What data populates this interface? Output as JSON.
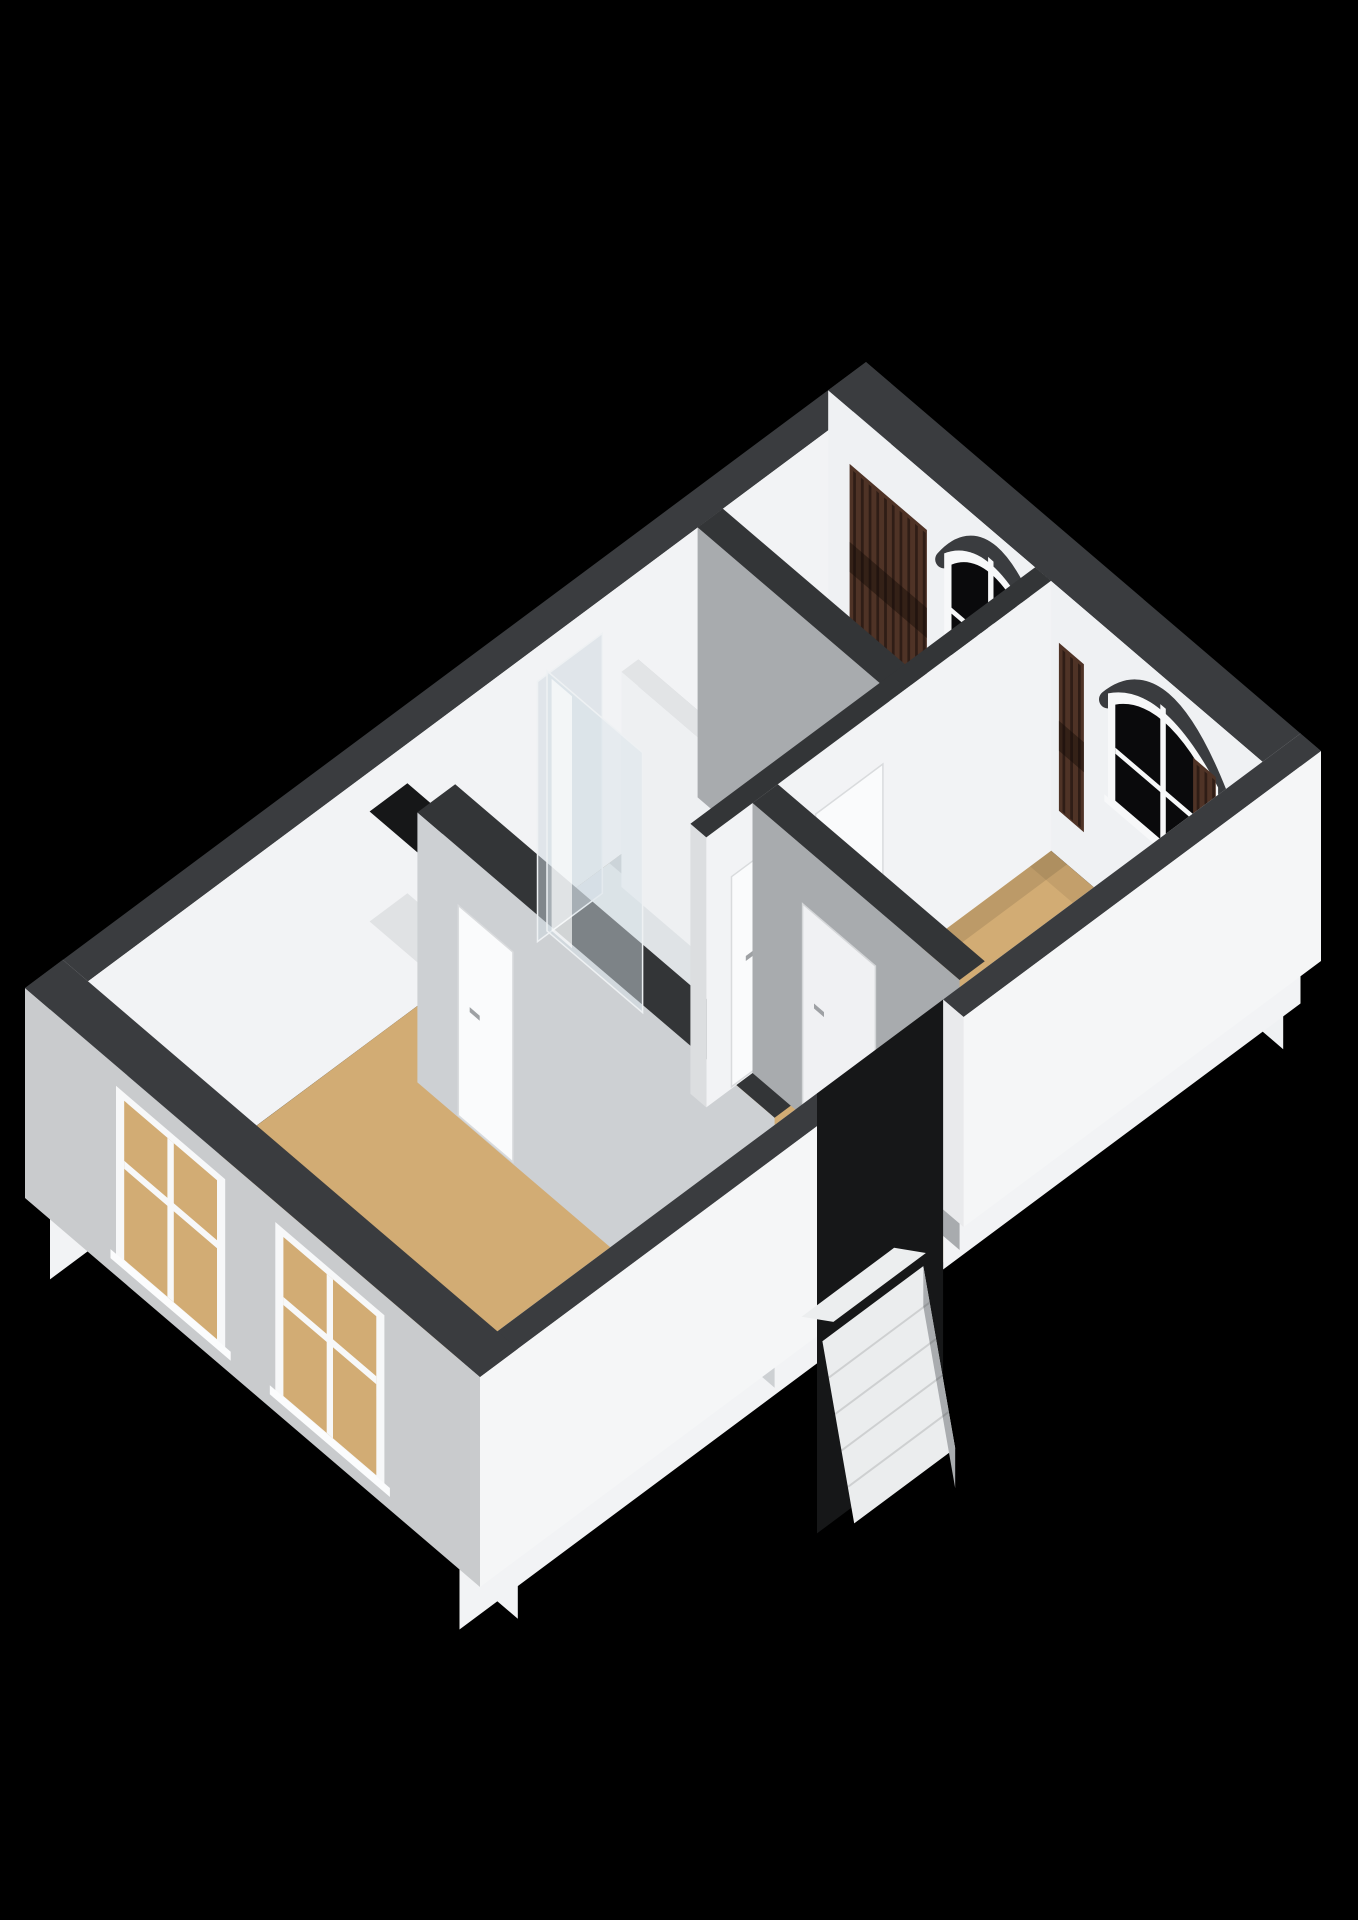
{
  "meta": {
    "description": "3D dollhouse-style floor plan render on black background, no visible text",
    "background": "#000000"
  },
  "canvas": {
    "width": 1358,
    "height": 1920
  },
  "projection": {
    "origin": [
      25,
      988
    ],
    "a_axis": [
      841,
      -626
    ],
    "b_axis": [
      455,
      389
    ],
    "wall_height": 270,
    "facade_drop": 210
  },
  "palette": {
    "cap": "#3a3c3f",
    "cap_int": "#333537",
    "wall_lit": "#f2f3f5",
    "wall_ne_int": "#eff1f3",
    "wall_gray": "#a8abae",
    "wall_gray_light": "#cdd0d3",
    "ext_sw": "#c9cbcd",
    "ext_se": "#f5f6f7",
    "floor": "#d2ac74",
    "bath_floor": "#dfe3e6",
    "bath_floor_dark": "#c4c9cd",
    "bath_floor_light": "#ecf0f3",
    "glass_dark": "#0a0a0c",
    "window_frame": "#f7f8f9",
    "wood_dark": "#4f3326",
    "wood_stripe": "#2f1d16",
    "door": "#fafbfc",
    "door_frame": "#d9dbdd",
    "handle": "#9ea1a4",
    "stair": "#ebedee",
    "stair_side": "#a9acaf",
    "void": "#161718",
    "ledge": "#e0e2e4",
    "sliver": "#e9eaec"
  },
  "floors": {
    "main": {
      "a1": 0.045,
      "b1": 0.055,
      "a2": 0.955,
      "b2": 0.945,
      "color": "floor"
    },
    "bathroom": {
      "a1": 0.545,
      "b1": 0.055,
      "a2": 0.77,
      "b2": 0.49,
      "color": "bath_floor"
    },
    "bathroom_far": {
      "a1": 0.665,
      "b1": 0.055,
      "a2": 0.77,
      "b2": 0.28,
      "color": "bath_floor_dark"
    },
    "bathroom_toilet": {
      "a1": 0.655,
      "b1": 0.28,
      "a2": 0.77,
      "b2": 0.49,
      "color": "bath_floor_light"
    },
    "shadows": [
      {
        "a1": 0.545,
        "b1": 0.49,
        "a2": 0.955,
        "b2": 0.525,
        "color": "rgba(0,0,0,0.10)"
      },
      {
        "a1": 0.93,
        "b1": 0.055,
        "a2": 0.955,
        "b2": 0.945,
        "color": "rgba(0,0,0,0.07)"
      },
      {
        "a1": 0.045,
        "b1": 0.055,
        "a2": 0.08,
        "b2": 0.945,
        "color": "rgba(0,0,0,0.06)"
      },
      {
        "a1": 0.38,
        "b1": 0.88,
        "a2": 0.545,
        "b2": 0.945,
        "color": "rgba(0,0,0,0.05)"
      }
    ]
  },
  "facades": {
    "nw": {
      "cap_b2": 0.055
    },
    "ne": {
      "cap_a1": 0.955,
      "windows": [
        {
          "name": "arched-window-1",
          "b1": 0.255,
          "b2": 0.46,
          "apex_z": 6,
          "arch_base_z": 64,
          "sill_z": 168
        },
        {
          "name": "arched-window-2",
          "b1": 0.615,
          "b2": 0.857,
          "apex_z": 6,
          "arch_base_z": 64,
          "sill_z": 168
        }
      ],
      "radiators": [
        {
          "name": "radiator-1",
          "b1": 0.06,
          "b2": 0.23
        },
        {
          "name": "radiator-2",
          "b1": 0.52,
          "b2": 0.575
        },
        {
          "name": "radiator-3",
          "b1": 0.815,
          "b2": 0.865
        }
      ],
      "radiator_plane": 0.948,
      "radiator_z1": 46,
      "radiator_z2": 214
    },
    "sw": {
      "cap_a2": 0.045,
      "windows": [
        {
          "name": "sw-window-1",
          "b1": 0.2,
          "b2": 0.44
        },
        {
          "name": "sw-window-2",
          "b1": 0.55,
          "b2": 0.79
        }
      ],
      "window_z1": 20,
      "window_z2": 195,
      "transom_z": 88
    },
    "se": {
      "cap_b1": 0.955,
      "segments": [
        [
          0.0,
          0.425
        ],
        [
          0.575,
          1.0
        ]
      ]
    }
  },
  "interior_walls": {
    "roomc_hall": {
      "a1": 0.38,
      "a2": 0.425,
      "b1": 0.16,
      "b2": 0.945,
      "door": {
        "name": "door-room-c",
        "t1": 0.25,
        "t2": 0.37,
        "handle_t": 0.275,
        "handle_z": 150
      }
    },
    "bath_south": {
      "a1": 0.545,
      "a2": 0.955,
      "b1": 0.455,
      "b2": 0.49,
      "doors": [
        {
          "name": "door-hall-1",
          "t1": 0.575,
          "t2": 0.655,
          "handle_t": 0.592,
          "handle_z": 148
        },
        {
          "name": "door-hall-2",
          "t1": 0.675,
          "t2": 0.755,
          "handle_t": 0.692,
          "handle_z": 148
        }
      ]
    },
    "bath_east": {
      "a1": 0.77,
      "a2": 0.8,
      "b1": 0.055,
      "b2": 0.49
    },
    "roomb_west": {
      "a1": 0.6,
      "a2": 0.63,
      "b1": 0.49,
      "b2": 0.945,
      "door": {
        "name": "door-room-b",
        "t1": 0.6,
        "t2": 0.76,
        "handle_t": 0.625,
        "handle_z": 148
      }
    }
  },
  "niche": {
    "a1": 0.38,
    "a2": 0.425,
    "b1": 0.055,
    "b2": 0.16,
    "ledge_z": 150
  },
  "bathroom_fixtures": {
    "partition": {
      "a1": 0.655,
      "a2": 0.675,
      "b1": 0.1,
      "b2": 0.42,
      "top_z": 55
    },
    "toilet": {
      "tank_b1": 0.3,
      "tank_b2": 0.4,
      "tank_plane": 0.692,
      "bowl_a": 0.722,
      "bowl_b": 0.35
    },
    "shower": {
      "panel_steep": {
        "b1": 0.09,
        "b2": 0.3,
        "plane": 0.572
      },
      "panel_long": {
        "a1": 0.558,
        "a2": 0.635,
        "plane": 0.095
      }
    }
  },
  "stairs": {
    "gap_a1": 0.425,
    "gap_a2": 0.575,
    "block_a1": 0.445,
    "block_a2": 0.565,
    "drop": 155,
    "wedge": {
      "a1": 0.45,
      "a2": 0.56,
      "b1": 0.875,
      "b2": 0.945,
      "rise": 22
    }
  },
  "door_geometry": {
    "height": 212,
    "top_z": 58
  }
}
